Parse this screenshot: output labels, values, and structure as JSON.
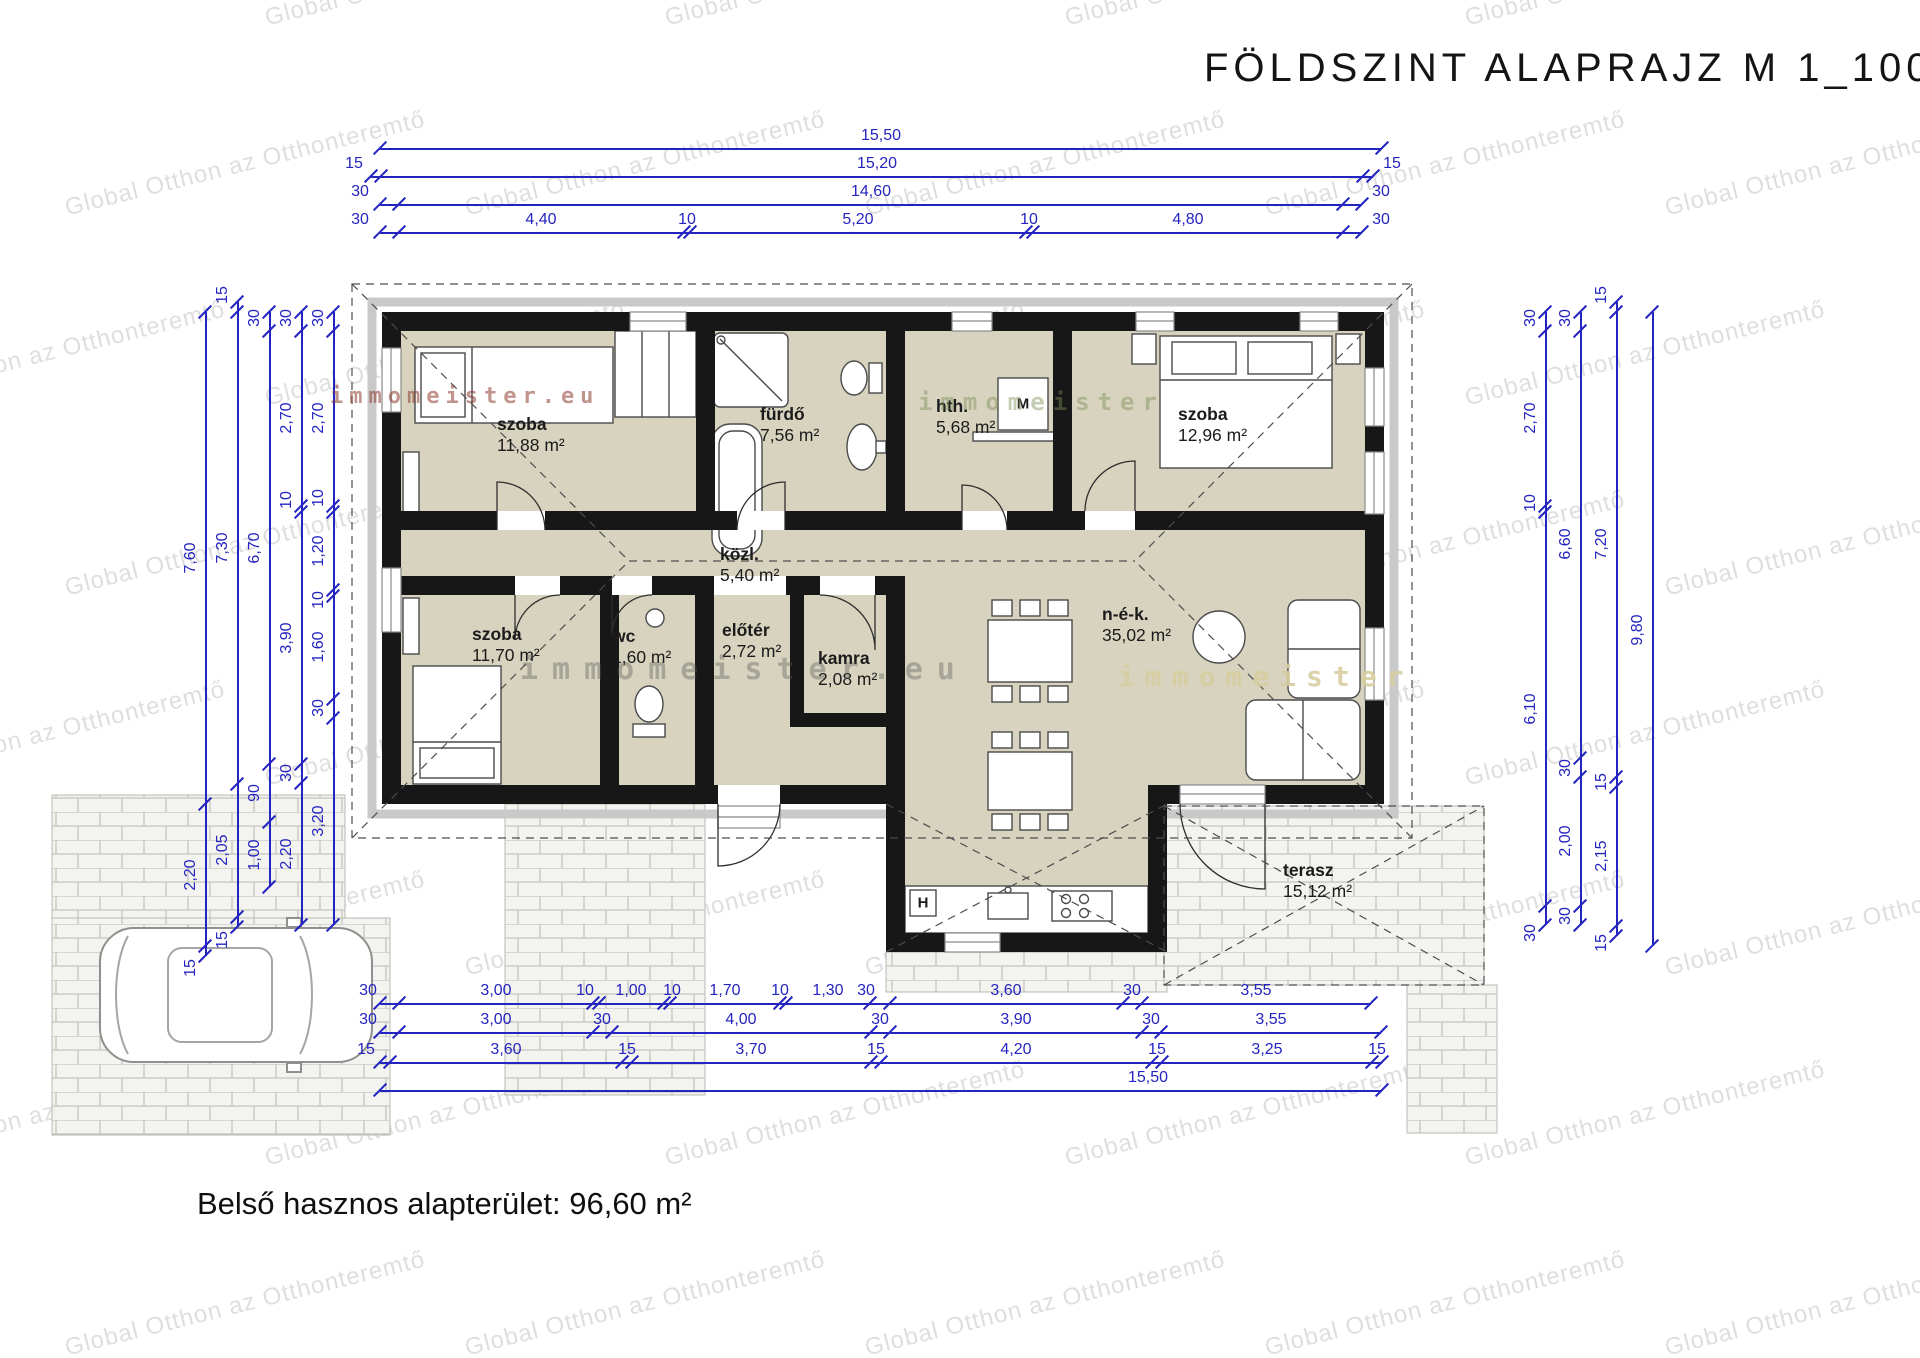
{
  "title": "FÖLDSZINT ALAPRAJZ M 1_100",
  "footer": "Belső hasznos alapterület: 96,60 m²",
  "watermark": {
    "text": "Global Otthon az Otthonteremtő"
  },
  "brand_marks": [
    {
      "text": "immomeister.eu",
      "x": 330,
      "y": 384,
      "color": "rgba(140,60,48,0.55)",
      "size": 22,
      "spacing": 6
    },
    {
      "text": "immomeister",
      "x": 918,
      "y": 388,
      "color": "rgba(125,143,86,0.45)",
      "size": 24,
      "spacing": 8
    },
    {
      "text": "immomeister.eu",
      "x": 520,
      "y": 652,
      "color": "rgba(90,90,90,0.38)",
      "size": 30,
      "spacing": 14
    },
    {
      "text": "immomeister",
      "x": 1118,
      "y": 660,
      "color": "rgba(216,205,160,0.9)",
      "size": 28,
      "spacing": 10
    }
  ],
  "colors": {
    "dimension": "#2424c0",
    "wall": "#171717",
    "room_fill": "#d7d3bf"
  },
  "plan": {
    "rooms": [
      {
        "name": "szoba",
        "area": "11,88 m²",
        "x": 497,
        "y": 414
      },
      {
        "name": "fürdő",
        "area": "7,56 m²",
        "x": 760,
        "y": 404
      },
      {
        "name": "hth.",
        "area": "5,68 m²",
        "x": 936,
        "y": 396
      },
      {
        "name": "szoba",
        "area": "12,96 m²",
        "x": 1178,
        "y": 404
      },
      {
        "name": "közl.",
        "area": "5,40 m²",
        "x": 720,
        "y": 544
      },
      {
        "name": "szoba",
        "area": "11,70 m²",
        "x": 472,
        "y": 624
      },
      {
        "name": "wc",
        "area": "1,60 m²",
        "x": 612,
        "y": 626
      },
      {
        "name": "előtér",
        "area": "2,72 m²",
        "x": 722,
        "y": 620
      },
      {
        "name": "kamra",
        "area": "2,08 m²",
        "x": 818,
        "y": 648
      },
      {
        "name": "n-é-k.",
        "area": "35,02 m²",
        "x": 1102,
        "y": 604
      },
      {
        "name": "terasz",
        "area": "15,12 m²",
        "x": 1283,
        "y": 860
      }
    ],
    "appliance_labels": [
      {
        "t": "M",
        "x": 1023,
        "y": 404
      },
      {
        "t": "H",
        "x": 923,
        "y": 903
      }
    ]
  },
  "dims": {
    "h": [
      {
        "y": 148,
        "x1": 380,
        "x2": 1382,
        "ticks": [
          380,
          1382
        ],
        "labels": [
          {
            "t": "15,50",
            "x": 881
          }
        ]
      },
      {
        "y": 176,
        "x1": 371,
        "x2": 1373,
        "ticks": [
          371,
          381,
          1363,
          1373
        ],
        "labels": [
          {
            "t": "15",
            "x": 354
          },
          {
            "t": "15,20",
            "x": 877
          },
          {
            "t": "15",
            "x": 1392
          }
        ]
      },
      {
        "y": 204,
        "x1": 380,
        "x2": 1362,
        "ticks": [
          380,
          399,
          1343,
          1362
        ],
        "labels": [
          {
            "t": "30",
            "x": 360
          },
          {
            "t": "14,60",
            "x": 871
          },
          {
            "t": "30",
            "x": 1381
          }
        ]
      },
      {
        "y": 232,
        "x1": 380,
        "x2": 1362,
        "ticks": [
          380,
          399,
          684,
          690,
          1026,
          1033,
          1343,
          1362
        ],
        "labels": [
          {
            "t": "30",
            "x": 360
          },
          {
            "t": "4,40",
            "x": 541
          },
          {
            "t": "10",
            "x": 687
          },
          {
            "t": "5,20",
            "x": 858
          },
          {
            "t": "10",
            "x": 1029
          },
          {
            "t": "4,80",
            "x": 1188
          },
          {
            "t": "30",
            "x": 1381
          }
        ]
      },
      {
        "y": 1003,
        "x1": 380,
        "x2": 1371,
        "ticks": [
          380,
          399,
          593,
          599,
          664,
          670,
          780,
          786,
          870,
          890,
          1123,
          1142,
          1371
        ],
        "labels": [
          {
            "t": "30",
            "x": 368
          },
          {
            "t": "3,00",
            "x": 496
          },
          {
            "t": "10",
            "x": 585
          },
          {
            "t": "1,00",
            "x": 631
          },
          {
            "t": "10",
            "x": 672
          },
          {
            "t": "1,70",
            "x": 725
          },
          {
            "t": "10",
            "x": 780
          },
          {
            "t": "1,30",
            "x": 828
          },
          {
            "t": "30",
            "x": 866
          },
          {
            "t": "3,60",
            "x": 1006
          },
          {
            "t": "30",
            "x": 1132
          },
          {
            "t": "3,55",
            "x": 1256
          }
        ]
      },
      {
        "y": 1032,
        "x1": 380,
        "x2": 1381,
        "ticks": [
          380,
          399,
          593,
          612,
          871,
          890,
          1142,
          1161,
          1381
        ],
        "labels": [
          {
            "t": "30",
            "x": 368
          },
          {
            "t": "3,00",
            "x": 496
          },
          {
            "t": "30",
            "x": 602
          },
          {
            "t": "4,00",
            "x": 741
          },
          {
            "t": "30",
            "x": 880
          },
          {
            "t": "3,90",
            "x": 1016
          },
          {
            "t": "30",
            "x": 1151
          },
          {
            "t": "3,55",
            "x": 1271
          }
        ]
      },
      {
        "y": 1062,
        "x1": 380,
        "x2": 1382,
        "ticks": [
          380,
          390,
          622,
          632,
          871,
          881,
          1152,
          1162,
          1372,
          1382
        ],
        "labels": [
          {
            "t": "15",
            "x": 366
          },
          {
            "t": "3,60",
            "x": 506
          },
          {
            "t": "15",
            "x": 627
          },
          {
            "t": "3,70",
            "x": 751
          },
          {
            "t": "15",
            "x": 876
          },
          {
            "t": "4,20",
            "x": 1016
          },
          {
            "t": "15",
            "x": 1157
          },
          {
            "t": "3,25",
            "x": 1267
          },
          {
            "t": "15",
            "x": 1377
          }
        ]
      },
      {
        "y": 1090,
        "x1": 380,
        "x2": 1382,
        "ticks": [
          380,
          1382
        ],
        "labels": [
          {
            "t": "15,50",
            "x": 1148
          }
        ]
      }
    ],
    "v": [
      {
        "x": 205,
        "y1": 312,
        "y2": 956,
        "ticks": [
          312,
          804,
          946,
          956
        ],
        "labels": [
          {
            "t": "7,60",
            "y": 558
          },
          {
            "t": "2,20",
            "y": 875
          },
          {
            "t": "15",
            "y": 968
          }
        ]
      },
      {
        "x": 237,
        "y1": 302,
        "y2": 927,
        "ticks": [
          302,
          312,
          784,
          917,
          927
        ],
        "labels": [
          {
            "t": "15",
            "y": 295
          },
          {
            "t": "7,30",
            "y": 548
          },
          {
            "t": "2,05",
            "y": 850
          },
          {
            "t": "15",
            "y": 940
          }
        ]
      },
      {
        "x": 269,
        "y1": 312,
        "y2": 887,
        "ticks": [
          312,
          331,
          764,
          822,
          887
        ],
        "labels": [
          {
            "t": "30",
            "y": 318
          },
          {
            "t": "6,70",
            "y": 548
          },
          {
            "t": "90",
            "y": 793
          },
          {
            "t": "1,00",
            "y": 855
          }
        ]
      },
      {
        "x": 301,
        "y1": 312,
        "y2": 925,
        "ticks": [
          312,
          331,
          506,
          512,
          764,
          783,
          925
        ],
        "labels": [
          {
            "t": "30",
            "y": 318
          },
          {
            "t": "2,70",
            "y": 418
          },
          {
            "t": "10",
            "y": 500
          },
          {
            "t": "3,90",
            "y": 638
          },
          {
            "t": "30",
            "y": 773
          },
          {
            "t": "2,20",
            "y": 854
          }
        ]
      },
      {
        "x": 333,
        "y1": 312,
        "y2": 925,
        "ticks": [
          312,
          331,
          506,
          512,
          590,
          596,
          699,
          718,
          925
        ],
        "labels": [
          {
            "t": "30",
            "y": 318
          },
          {
            "t": "2,70",
            "y": 418
          },
          {
            "t": "10",
            "y": 498
          },
          {
            "t": "1,20",
            "y": 551
          },
          {
            "t": "10",
            "y": 600
          },
          {
            "t": "1,60",
            "y": 647
          },
          {
            "t": "30",
            "y": 708
          },
          {
            "t": "3,20",
            "y": 821
          }
        ]
      },
      {
        "x": 1545,
        "y1": 312,
        "y2": 925,
        "ticks": [
          312,
          331,
          506,
          512,
          906,
          925
        ],
        "labels": [
          {
            "t": "30",
            "y": 318
          },
          {
            "t": "2,70",
            "y": 418
          },
          {
            "t": "10",
            "y": 503
          },
          {
            "t": "6,10",
            "y": 709
          },
          {
            "t": "30",
            "y": 933
          }
        ]
      },
      {
        "x": 1580,
        "y1": 312,
        "y2": 925,
        "ticks": [
          312,
          331,
          758,
          777,
          906,
          925
        ],
        "labels": [
          {
            "t": "30",
            "y": 318
          },
          {
            "t": "6,60",
            "y": 544
          },
          {
            "t": "30",
            "y": 768
          },
          {
            "t": "2,00",
            "y": 841
          },
          {
            "t": "30",
            "y": 916
          }
        ]
      },
      {
        "x": 1616,
        "y1": 302,
        "y2": 936,
        "ticks": [
          302,
          312,
          777,
          787,
          926,
          936
        ],
        "labels": [
          {
            "t": "15",
            "y": 295
          },
          {
            "t": "7,20",
            "y": 544
          },
          {
            "t": "15",
            "y": 782
          },
          {
            "t": "2,15",
            "y": 856
          },
          {
            "t": "15",
            "y": 943
          }
        ]
      },
      {
        "x": 1652,
        "y1": 312,
        "y2": 946,
        "ticks": [
          312,
          946
        ],
        "labels": [
          {
            "t": "9,80",
            "y": 630
          }
        ]
      }
    ]
  }
}
